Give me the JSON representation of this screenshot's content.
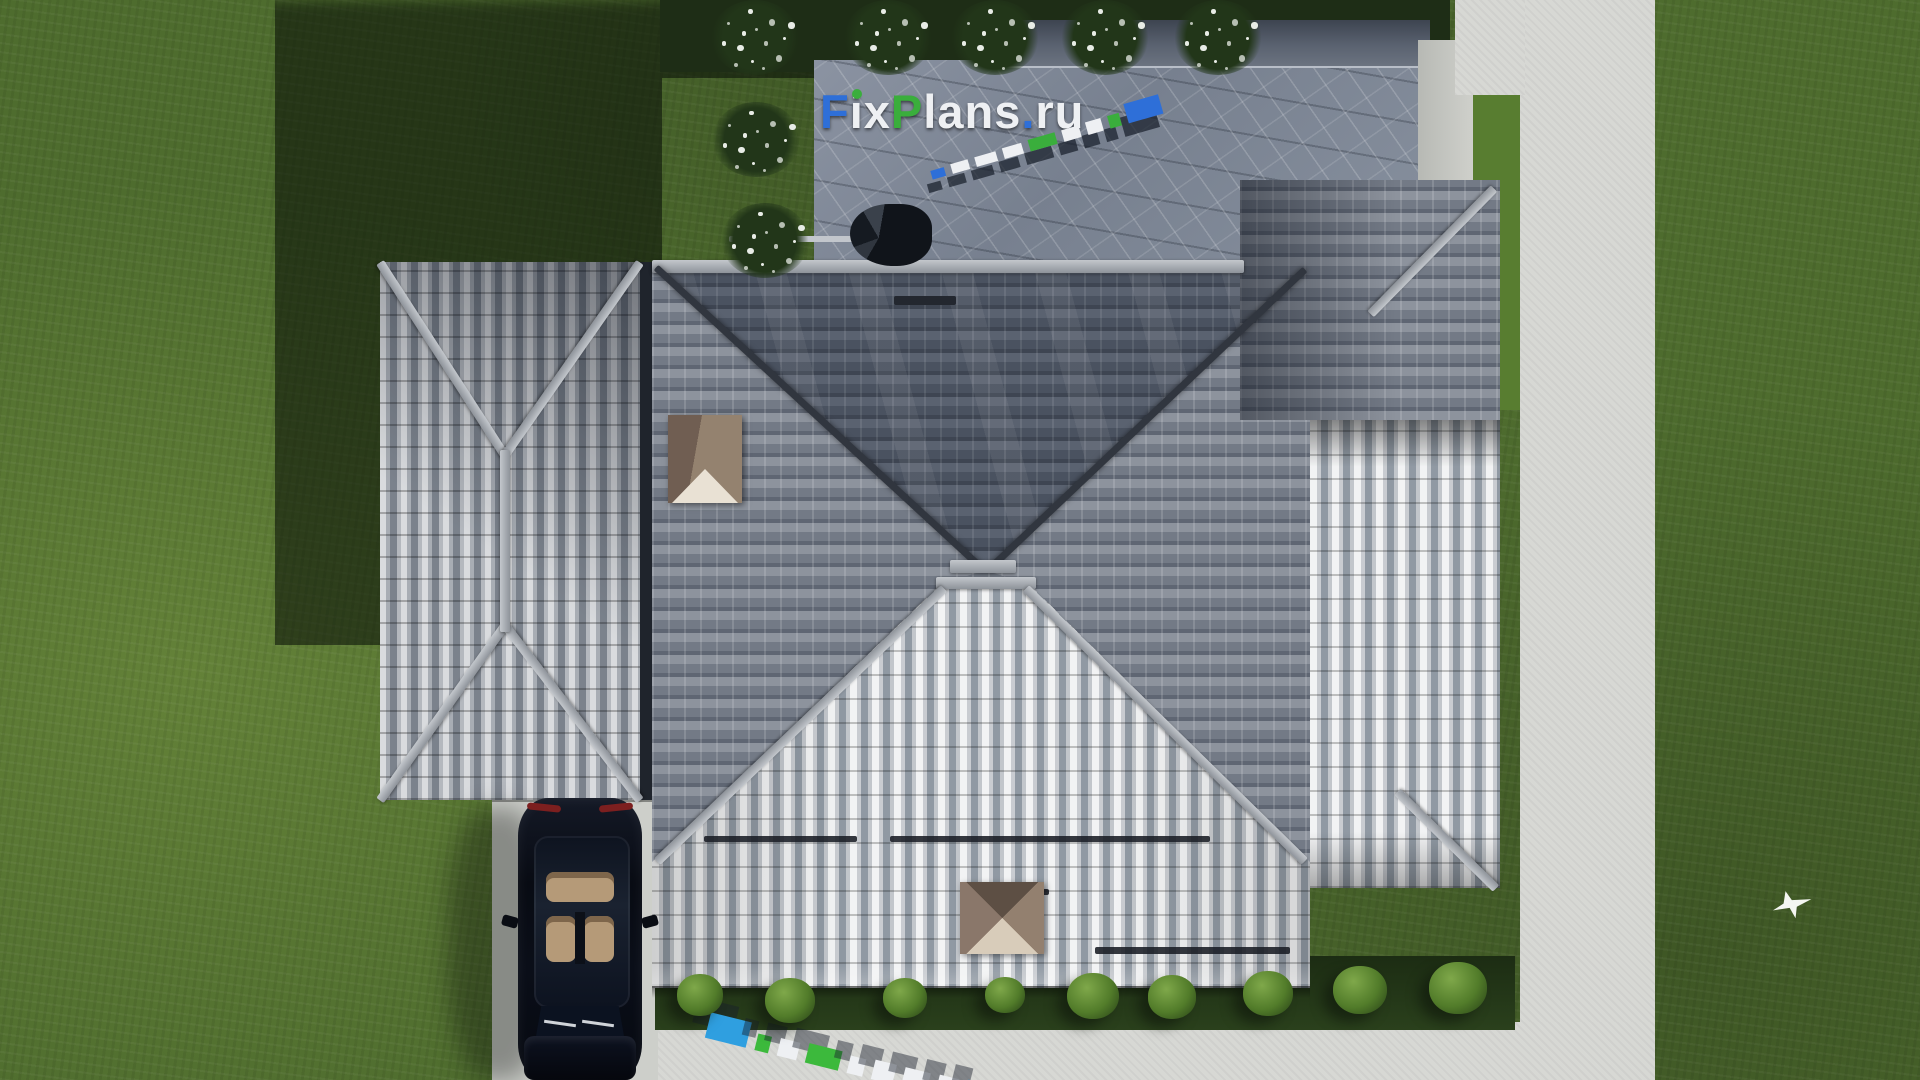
{
  "watermark": {
    "text": "FixPlans.ru",
    "parts": [
      {
        "text": "F",
        "color": "#2e6fd8"
      },
      {
        "text": "i",
        "color": "#eef0f3",
        "dot_color": "#3aae3c"
      },
      {
        "text": "x",
        "color": "#eef0f3"
      },
      {
        "text": "P",
        "color": "#3aae3c"
      },
      {
        "text": "lans",
        "color": "#eef0f3"
      },
      {
        "text": ".",
        "color": "#2e6fd8"
      },
      {
        "text": "ru",
        "color": "#eef0f3"
      }
    ]
  },
  "watermark_3d_roof": {
    "represents": "FixPlans.ru",
    "blocks": [
      {
        "w": 14,
        "h": 9,
        "c": "#2e6fd8"
      },
      {
        "w": 18,
        "h": 10,
        "c": "#eef0f3"
      },
      {
        "w": 22,
        "h": 10,
        "c": "#eef0f3"
      },
      {
        "w": 20,
        "h": 11,
        "c": "#eef0f3"
      },
      {
        "w": 28,
        "h": 12,
        "c": "#3aae3c"
      },
      {
        "w": 18,
        "h": 12,
        "c": "#eef0f3"
      },
      {
        "w": 16,
        "h": 13,
        "c": "#eef0f3"
      },
      {
        "w": 12,
        "h": 13,
        "c": "#3aae3c"
      },
      {
        "w": 36,
        "h": 20,
        "c": "#2e6fd8"
      }
    ]
  },
  "watermark_3d_ground": {
    "represents": "FixPlans.ru",
    "blocks": [
      {
        "w": 42,
        "h": 26,
        "c": "#2f9fe0"
      },
      {
        "w": 14,
        "h": 17,
        "c": "#3cb93c"
      },
      {
        "w": 20,
        "h": 18,
        "c": "#eef0f3"
      },
      {
        "w": 34,
        "h": 20,
        "c": "#3cb93c"
      },
      {
        "w": 16,
        "h": 18,
        "c": "#eef0f3"
      },
      {
        "w": 22,
        "h": 20,
        "c": "#eef0f3"
      },
      {
        "w": 26,
        "h": 20,
        "c": "#eef0f3"
      },
      {
        "w": 20,
        "h": 21,
        "c": "#eef0f3"
      },
      {
        "w": 18,
        "h": 23,
        "c": "#2f9fe0"
      }
    ]
  },
  "landscape": {
    "flower_bushes": [
      [
        755,
        28
      ],
      [
        888,
        26
      ],
      [
        995,
        26
      ],
      [
        1105,
        28
      ],
      [
        1218,
        30
      ],
      [
        756,
        137
      ],
      [
        765,
        238
      ]
    ],
    "green_bushes": [
      [
        700,
        995,
        46
      ],
      [
        790,
        1000,
        50
      ],
      [
        905,
        998,
        44
      ],
      [
        1005,
        995,
        40
      ],
      [
        1093,
        996,
        52
      ],
      [
        1172,
        997,
        48
      ],
      [
        1268,
        993,
        50
      ],
      [
        1360,
        990,
        54
      ],
      [
        1458,
        988,
        58
      ]
    ]
  },
  "palette": {
    "grass": "#4e6c2e",
    "grass_shadow": "#22301a",
    "roof_dark": "#3e4552",
    "roof_light": "#e9ebed",
    "ridge": "#a7abb1",
    "patio_marble": "#828b99",
    "concrete": "#d7d8d4",
    "chimney": "#8d7a6d",
    "car_body": "#0a0e18",
    "car_interior": "#b59a78",
    "accent_blue": "#2e6fd8",
    "accent_green": "#3aae3c"
  }
}
